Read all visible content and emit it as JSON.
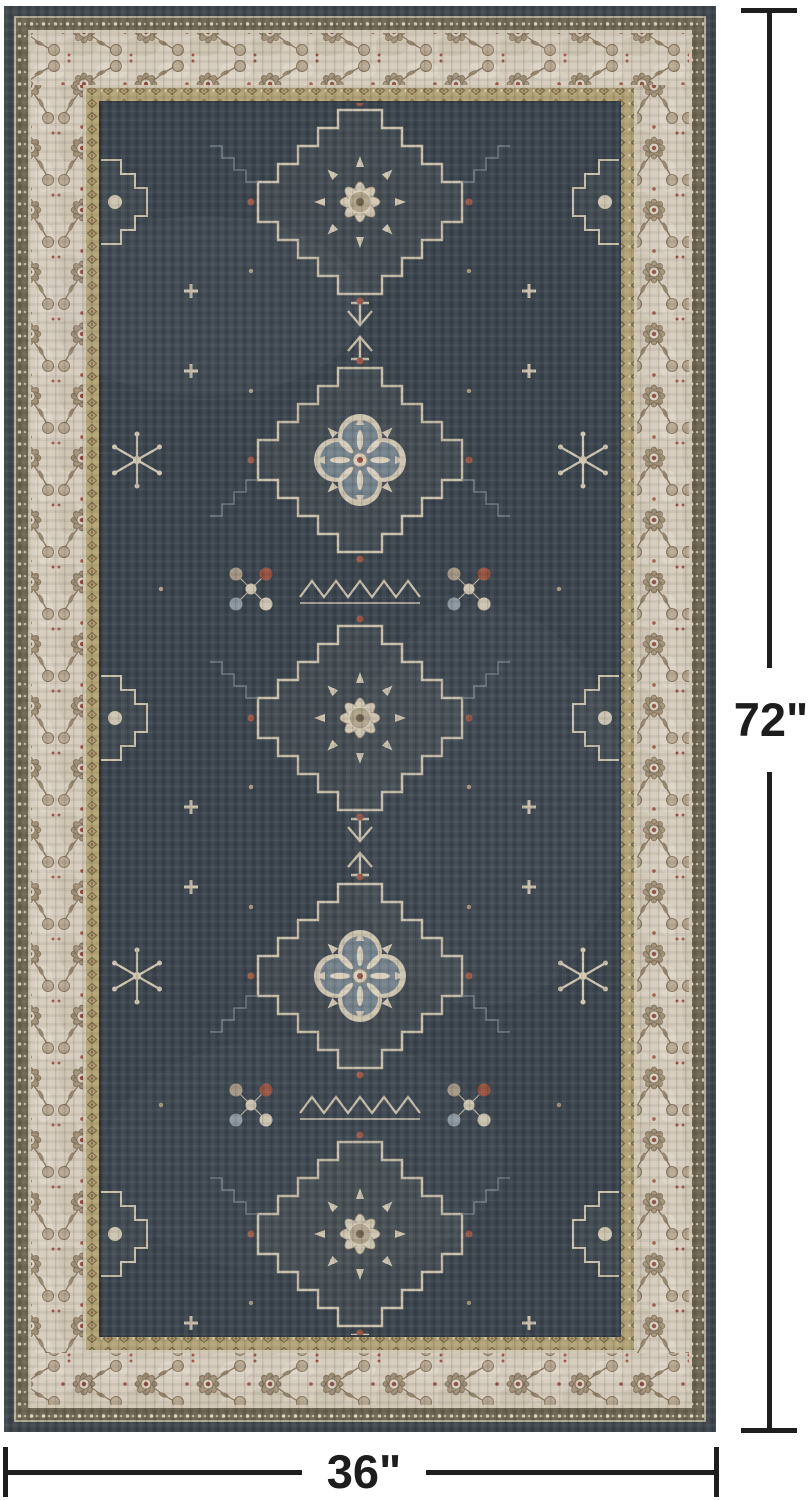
{
  "page": {
    "background_color": "#ffffff"
  },
  "product_photo": {
    "subject": "oriental-area-rug",
    "rug": {
      "colors": {
        "outer_edge": "#3e464c",
        "edge_pinline": "#b9b09a",
        "guard_band": "#6b6350",
        "cream_line": "#cfc5b1",
        "ivory_border": "#d5ccbc",
        "border_motif": "#a29178",
        "gold_band": "#b2a276",
        "field_pinline": "#2e353b",
        "field": "#3a434c",
        "motif_cream": "#d3c9b6",
        "motif_blue_gray": "#76848c",
        "accent_rust": "#9b5847"
      }
    }
  },
  "annotations": {
    "line_color": "#1e1e1e",
    "height_dimension": {
      "label": "72\""
    },
    "width_dimension": {
      "label": "36\""
    }
  }
}
